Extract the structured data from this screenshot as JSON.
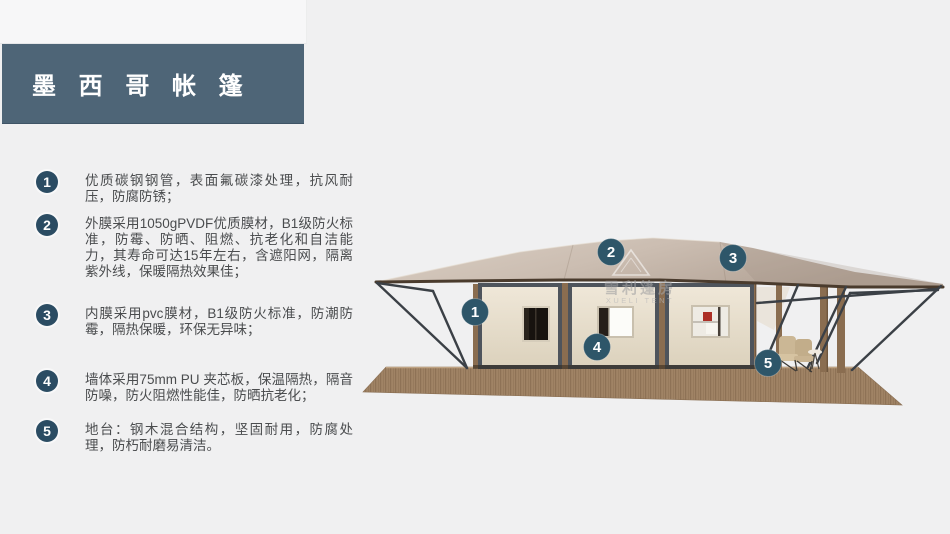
{
  "title": {
    "text": "墨 西 哥 帐 篷"
  },
  "colors": {
    "accent_bar": "#4e6577",
    "list_circle": "#2b4c63",
    "callout_circle": "#2e5669",
    "body_text": "#4a4c4e",
    "background": "#f0f0f1",
    "roof_membrane": "#c9bcb0",
    "wall_panel": "#e9e1d1",
    "deck_wood": "#9c7f63"
  },
  "features": [
    {
      "num": "1",
      "text": "优质碳钢钢管，表面氟碳漆处理，抗风耐压，防腐防锈；"
    },
    {
      "num": "2",
      "text": "外膜采用1050gPVDF优质膜材，B1级防火标准，防霉、防晒、阻燃、抗老化和自洁能力，其寿命可达15年左右，含遮阳网，隔离紫外线，保暖隔热效果佳；"
    },
    {
      "num": "3",
      "text": "内膜采用pvc膜材，B1级防火标准，防潮防霉，隔热保暖，环保无异味；"
    },
    {
      "num": "4",
      "text": "墙体采用75mm PU 夹芯板，保温隔热，隔音防噪，防火阻燃性能佳，防晒抗老化；"
    },
    {
      "num": "5",
      "text": "地台：钢木混合结构，坚固耐用，防腐处理，防朽耐磨易清洁。"
    }
  ],
  "callouts": [
    {
      "num": "1"
    },
    {
      "num": "2"
    },
    {
      "num": "3"
    },
    {
      "num": "4"
    },
    {
      "num": "5"
    }
  ],
  "watermark": {
    "cn": "雪利篷房",
    "en": "XUELI TENT"
  }
}
